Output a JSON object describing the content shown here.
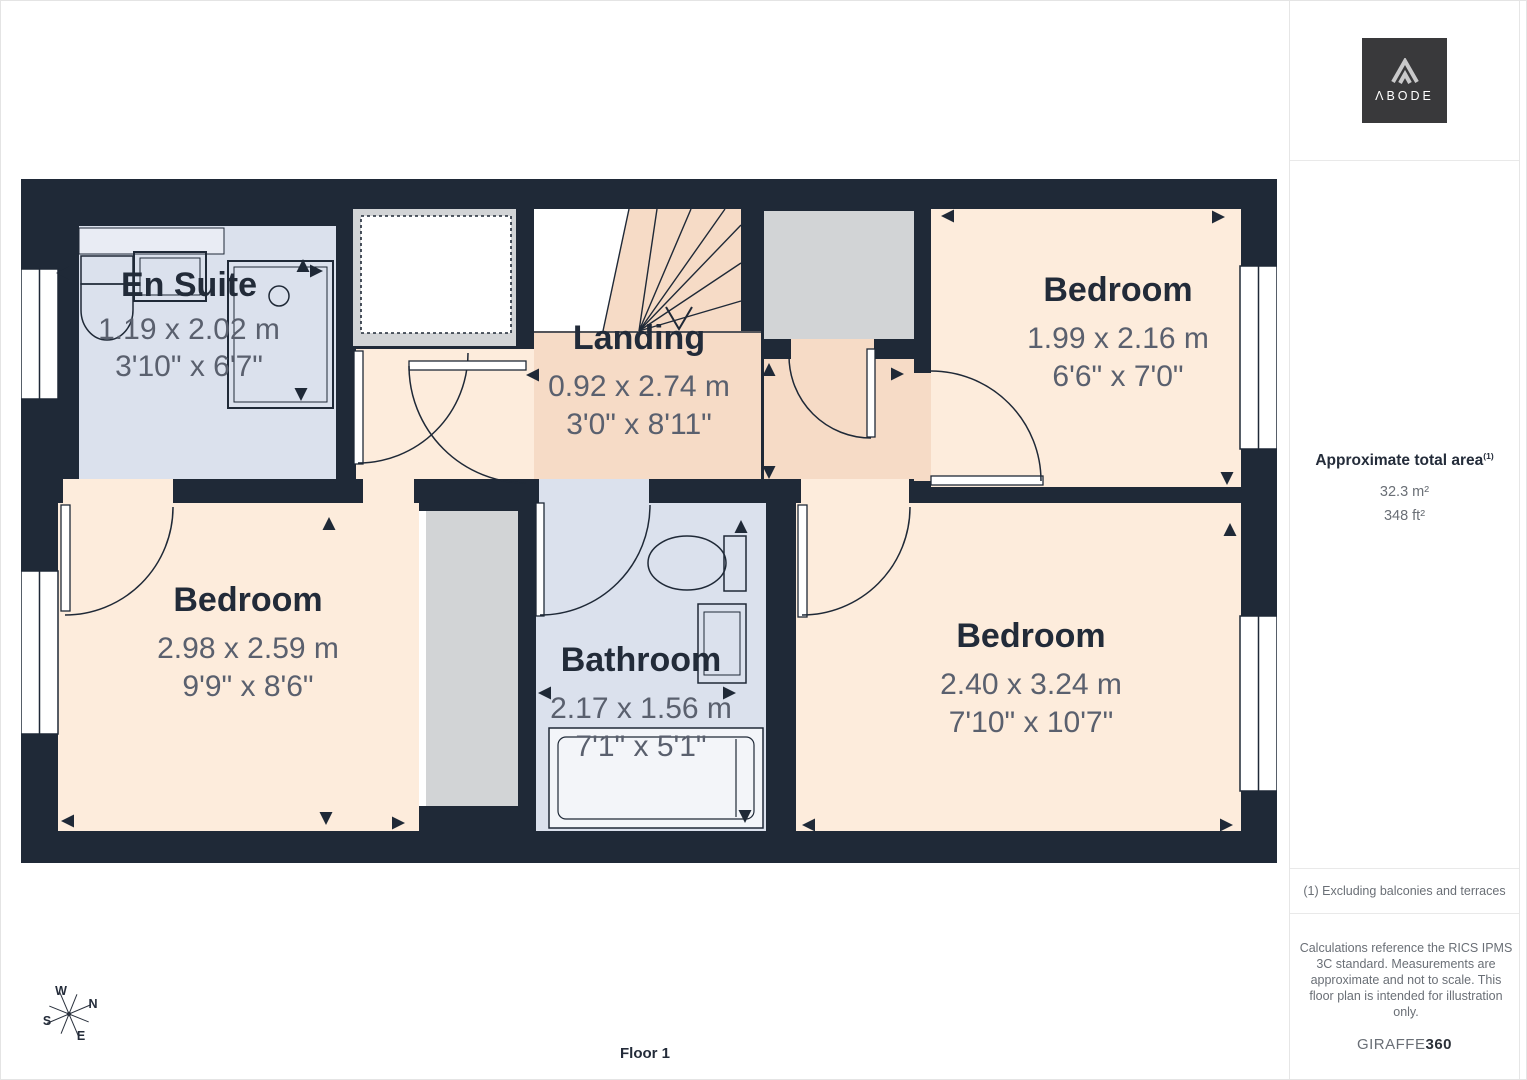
{
  "logo": {
    "text": "ΛBODE"
  },
  "sidebar": {
    "area_heading": "Approximate total area",
    "area_marker": "(1)",
    "area_metric": "32.3 m²",
    "area_imperial": "348 ft²",
    "footnote": "(1) Excluding balconies and terraces",
    "disclaimer": "Calculations reference the RICS IPMS 3C standard. Measurements are approximate and not to scale. This floor plan is intended for illustration only.",
    "credit_name": "GIRAFFE",
    "credit_number": "360"
  },
  "plan": {
    "floor_label": "Floor 1",
    "compass": {
      "north": "N",
      "east": "E",
      "south": "S",
      "west": "W"
    },
    "rooms": [
      {
        "name": "En Suite",
        "metric": "1.19 x 2.02 m",
        "imperial": "3'10\" x 6'7\""
      },
      {
        "name": "Landing",
        "metric": "0.92 x 2.74 m",
        "imperial": "3'0\" x 8'11\""
      },
      {
        "name": "Bedroom",
        "metric": "1.99 x 2.16 m",
        "imperial": "6'6\" x 7'0\""
      },
      {
        "name": "Bedroom",
        "metric": "2.98 x 2.59 m",
        "imperial": "9'9\" x 8'6\""
      },
      {
        "name": "Bathroom",
        "metric": "2.17 x 1.56 m",
        "imperial": "7'1\" x 5'1\""
      },
      {
        "name": "Bedroom",
        "metric": "2.40 x 3.24 m",
        "imperial": "7'10\" x 10'7\""
      }
    ],
    "colors": {
      "wall": "#1f2937",
      "bedroom_floor": "#fdecdc",
      "landing_floor": "#f6dbc6",
      "bathroom_floor": "#dbe1ed",
      "storage_floor": "#d2d4d6"
    }
  }
}
